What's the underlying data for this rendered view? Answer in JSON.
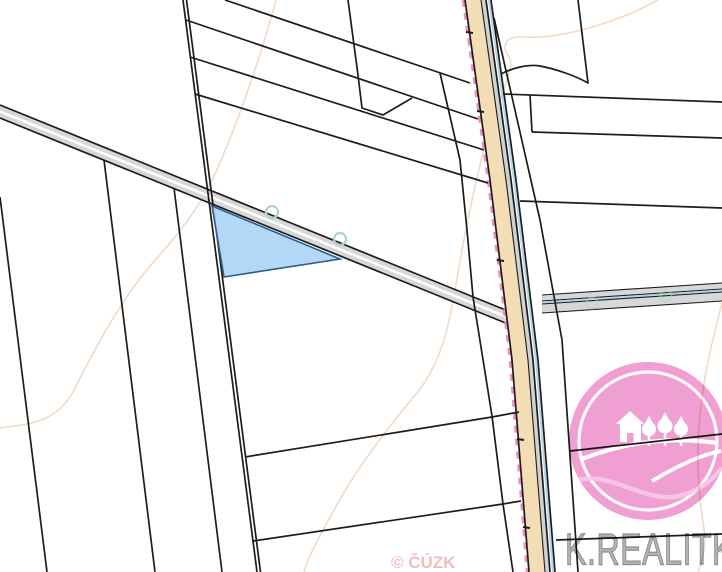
{
  "app": {
    "name": "cadastral-map-view"
  },
  "watermarks": {
    "copyright": "© ČÚZK",
    "brand": "K.REALITKA"
  },
  "map": {
    "type": "cadastral parcel map",
    "highlighted_parcel": {
      "shape": "triangle",
      "position": "below diagonal road, center-left"
    },
    "boundary_point_markers": 4,
    "colors": {
      "parcel_line": "#1c1c1c",
      "road_gray_fill": "#d7d7d7",
      "road_tan_fill": "#f3ddb4",
      "road_edge_strip": "#d2d2d2",
      "contour_line": "#edd0b8",
      "pink_dash": "#ee8fc2",
      "water_line": "#abd0e6",
      "marker_circle": "#a9d8c0",
      "highlight_fill": "#a7d1f6",
      "highlight_stroke": "#2e5d8e",
      "logo_pink": "#ef9fd2",
      "logo_inner_pink": "#f6c9e8",
      "brand_text": "#b3b3b3",
      "copyright_text": "rgba(233,135,135,0.55)"
    }
  },
  "logo": {
    "shape": "pink circle watermark",
    "icons": [
      "house-icon",
      "trees-icon",
      "hills-icon"
    ]
  }
}
